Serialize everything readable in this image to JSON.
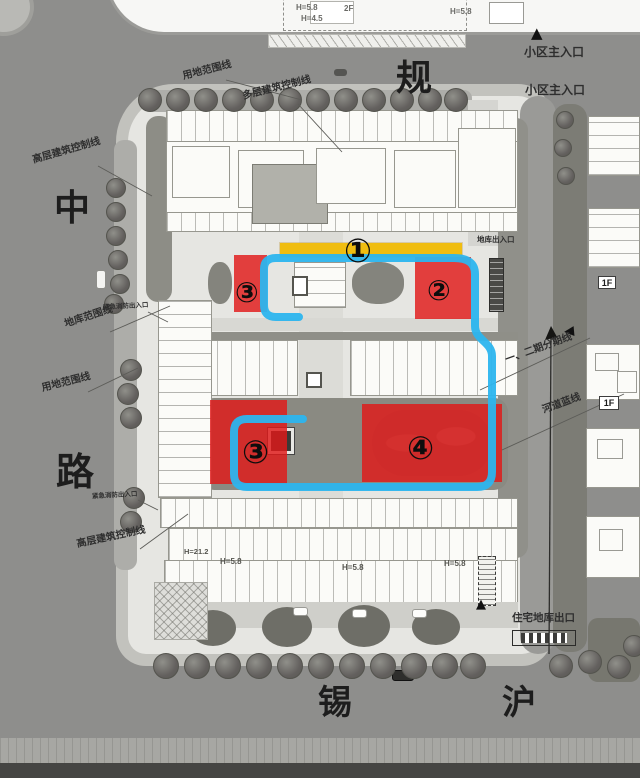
{
  "plan": {
    "streets": {
      "top": "规",
      "left_top": "中",
      "left_bottom": "路",
      "bottom_left": "锡",
      "bottom_right": "沪"
    },
    "entrances": {
      "main_1": "小区主入口",
      "main_2": "小区主入口",
      "garage_top": "地库出入口",
      "residential_garage_exit": "住宅地库出口",
      "fire_1": "紧急消防出入口",
      "fire_2": "紧急消防出入口"
    },
    "boundaries": {
      "use_top": "用地范围线",
      "multi_storey_top": "多层建筑控制线",
      "highrise_top": "高层建筑控制线",
      "garage_line": "地库范围线",
      "use_left": "用地范围线",
      "highrise_bottom": "高层建筑控制线",
      "phase_line": "一、二期分期线",
      "river_line": "河道蓝线"
    },
    "zones": {
      "z1": {
        "num": "①"
      },
      "z2": {
        "num": "②"
      },
      "z3a": {
        "num": "③"
      },
      "z3b": {
        "num": "③"
      },
      "z4": {
        "num": "④"
      }
    },
    "building_labels": {
      "h58_a": "H=5.8",
      "h45_a": "H=4.5",
      "f2": "2F",
      "h58_b": "H=5.8",
      "f1_a": "1F",
      "f1_b": "1F",
      "h212": "H=21.2",
      "h58_c": "H=5.8",
      "h58_d": "H=5.8",
      "h58_e": "H=5.8"
    },
    "colors": {
      "route_blue": "#2cb5ee",
      "highlight_yellow": "#f0bd10",
      "zone_red": "#e11d1d"
    }
  }
}
